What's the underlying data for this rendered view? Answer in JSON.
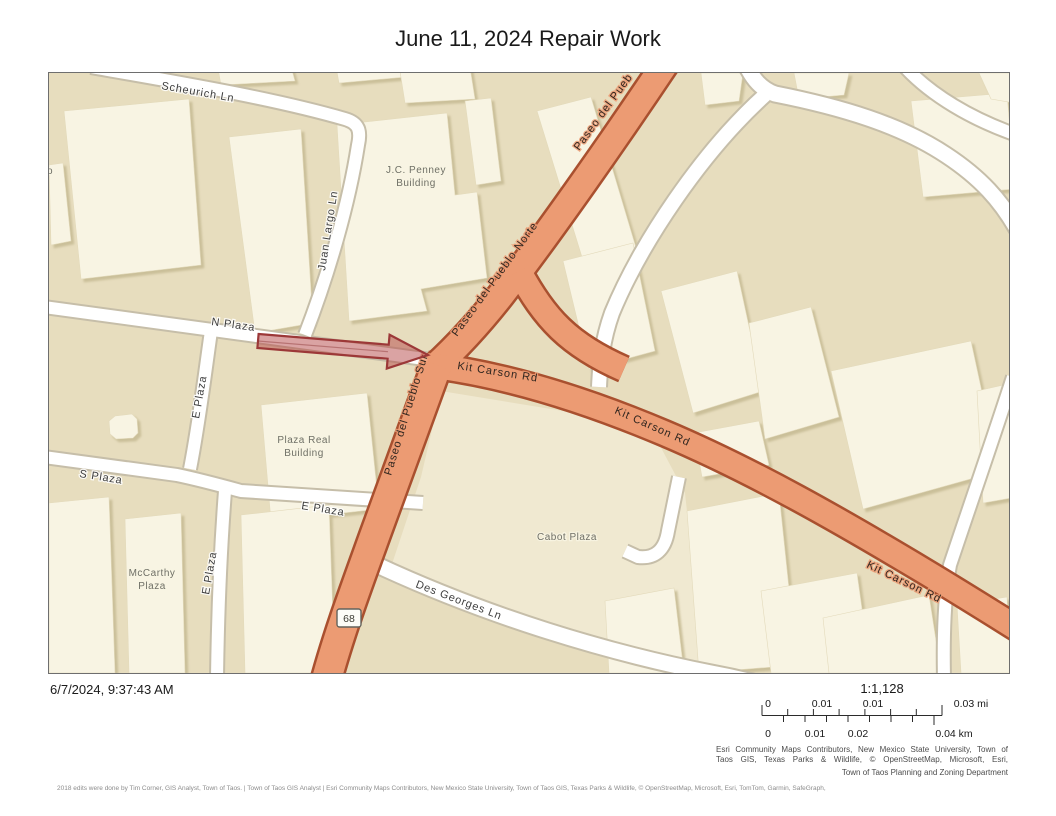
{
  "title": "June 11, 2024 Repair Work",
  "map": {
    "labels": {
      "scheurich": "Scheurich Ln",
      "juan_largo": "Juan Largo Ln",
      "n_plaza": "N Plaza",
      "e_plaza_upper": "E Plaza",
      "s_plaza": "S Plaza",
      "e_plaza_mid": "E Plaza",
      "e_plaza_lower": "E Plaza",
      "des_georges": "Des Georges Ln",
      "paseo_norte": "Paseo del Pueblo Norte",
      "paseo_norte_top": "Paseo del Pueb",
      "paseo_sur": "Paseo del Pueblo Sur",
      "kit_carson_1": "Kit Carson Rd",
      "kit_carson_2": "Kit Carson Rd",
      "kit_carson_3": "Kit Carson Rd",
      "jc_penney_1": "J.C. Penney",
      "jc_penney_2": "Building",
      "plaza_real_1": "Plaza Real",
      "plaza_real_2": "Building",
      "mccarthy_1": "McCarthy",
      "mccarthy_2": "Plaza",
      "cabot": "Cabot Plaza",
      "edge_partial": "o"
    },
    "route_shield": "68",
    "colors": {
      "background_tan": "#E7DDBE",
      "building_cream": "#F8F4E3",
      "highway_fill": "#EC9B73",
      "highway_casing": "#A9502F",
      "minor_road": "#FFFFFF",
      "arrow_stroke": "#9C3838"
    }
  },
  "footer": {
    "timestamp": "6/7/2024, 9:37:43 AM",
    "scale_ratio": "1:1,128",
    "scale_mi": {
      "t0": "0",
      "t1": "0.01",
      "t2": "0.01",
      "t3": "0.03 mi"
    },
    "scale_km": {
      "t0": "0",
      "t1": "0.01",
      "t2": "0.02",
      "t3": "0.04 km"
    },
    "attribution_line1": "Esri Community Maps Contributors, New Mexico State University, Town of",
    "attribution_line2": "Taos GIS, Texas Parks & Wildlife, © OpenStreetMap, Microsoft, Esri,",
    "department": "Town of Taos Planning and Zoning Department",
    "credits": "2018 edits were done by Tim Corner, GIS Analyst, Town of Taos. | Town of Taos GIS Analyst | Esri Community Maps Contributors, New Mexico State University, Town of Taos GIS, Texas Parks & Wildlife, © OpenStreetMap, Microsoft, Esri, TomTom, Garmin, SafeGraph,"
  }
}
